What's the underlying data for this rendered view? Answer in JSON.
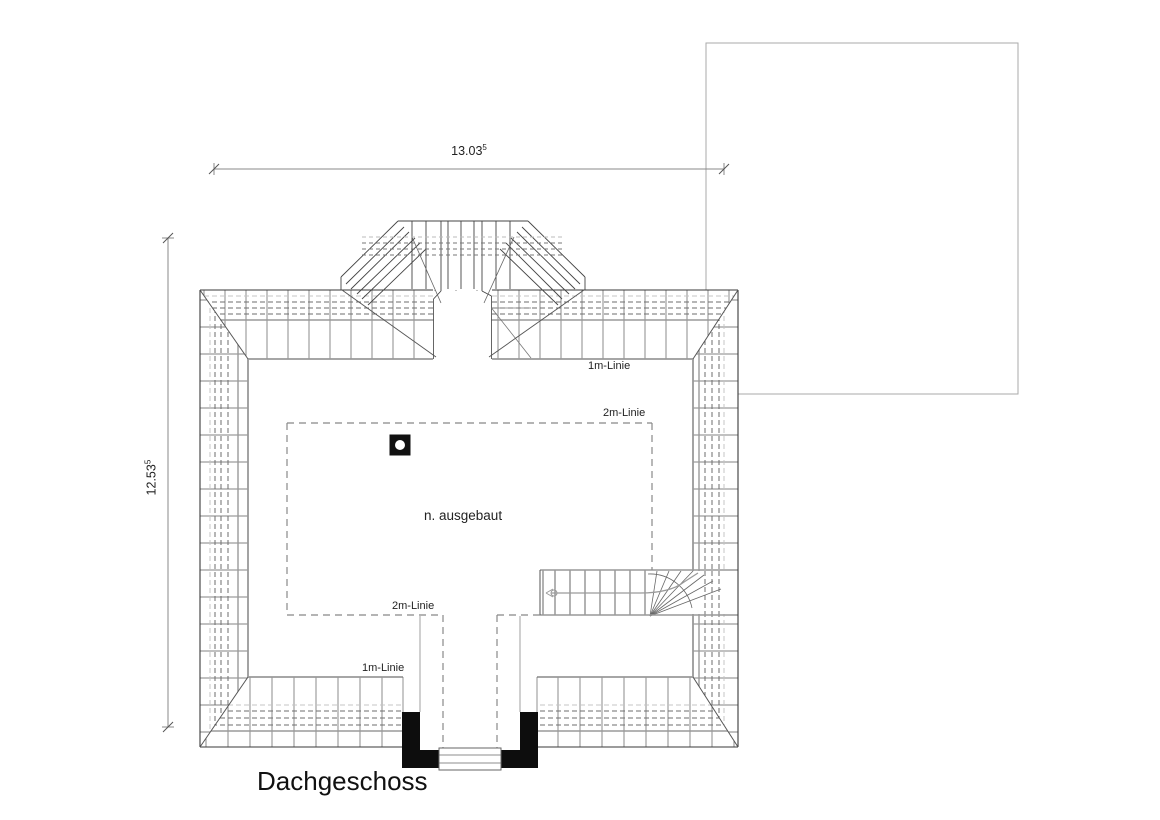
{
  "title": "Dachgeschoss",
  "drawing": {
    "floor_label": "Dachgeschoss",
    "room_label": "n. ausgebaut",
    "line_labels": {
      "one_m_top": "1m-Linie",
      "two_m_top": "2m-Linie",
      "two_m_bottom": "2m-Linie",
      "one_m_bottom": "1m-Linie"
    },
    "dimensions": {
      "width_value": "13.03",
      "width_sup": "5",
      "height_value": "12.53",
      "height_sup": "5"
    }
  },
  "colors": {
    "ink": "#1a1a1a",
    "wall_black": "#0d0d0d",
    "line_gray": "#999999",
    "hatch_gray": "#5a5a5a",
    "dim_gray": "#888888"
  }
}
